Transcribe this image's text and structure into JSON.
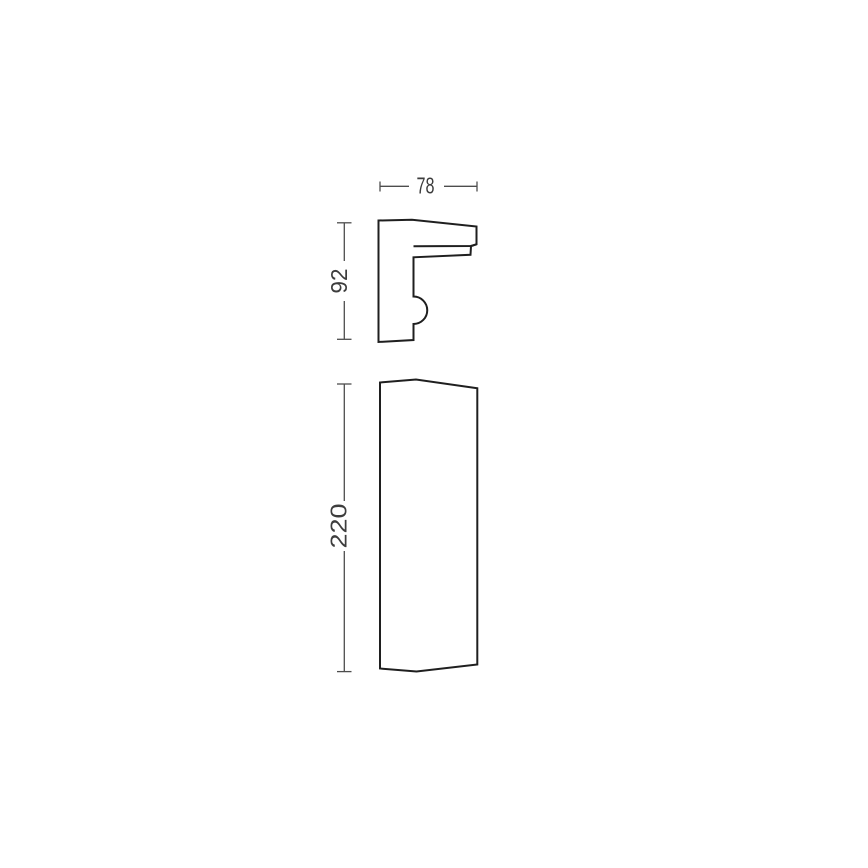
{
  "drawing": {
    "type": "technical-dimension-diagram",
    "views": {
      "side_profile": "side-profile",
      "front_elevation": "front-elevation"
    },
    "dimensions": {
      "width": "78",
      "side_height": "92",
      "front_height": "220"
    },
    "colors": {
      "outline": "#1f1f1f",
      "dimension_line": "#4d4d4d",
      "label_text": "#3d3d3d",
      "background": "#ffffff"
    }
  }
}
